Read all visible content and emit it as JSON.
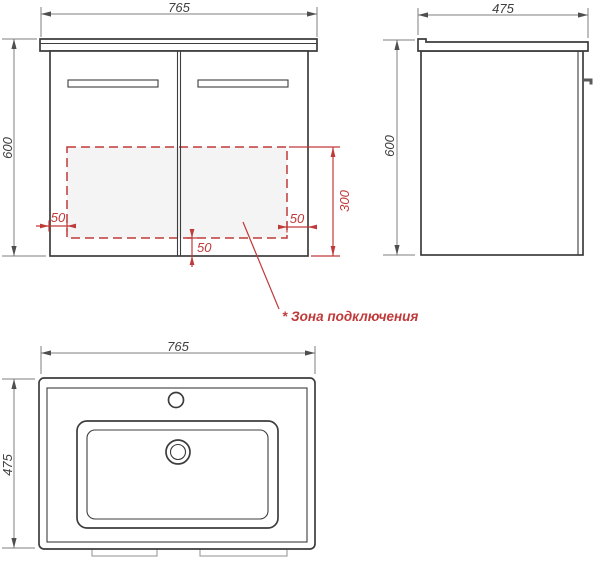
{
  "title": "Vanity cabinet with basin - dimensional drawing",
  "views": {
    "front": {
      "width_mm": "765",
      "height_mm": "600",
      "connection_zone": {
        "label": "* Зона подключения",
        "inset_left_mm": "50",
        "inset_right_mm": "50",
        "inset_bottom_mm": "50",
        "height_mm": "300"
      }
    },
    "side": {
      "depth_mm": "475",
      "height_mm": "600"
    },
    "basin_top": {
      "width_mm": "765",
      "depth_mm": "475"
    }
  },
  "colors": {
    "outline": "#3d3d3d",
    "dimension_line": "#7f7f7f",
    "dimension_text": "#3f3f3f",
    "accent_red": "#c03a3a",
    "zone_fill": "#f4f4f4",
    "background": "#ffffff"
  }
}
